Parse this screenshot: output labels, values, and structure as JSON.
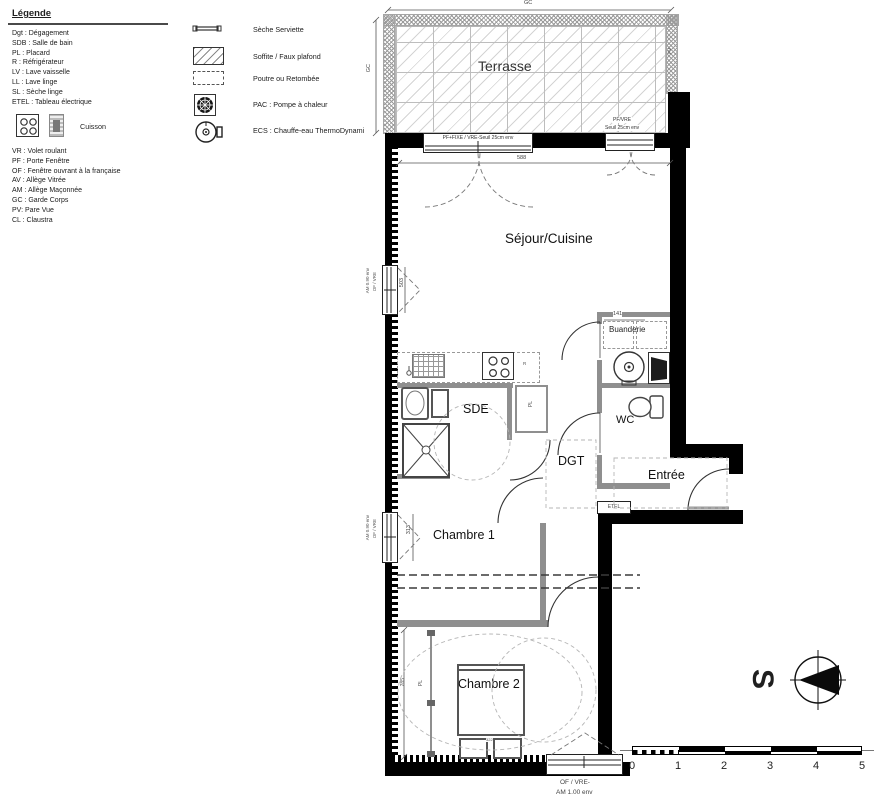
{
  "legend": {
    "title": "Légende",
    "abbr1": [
      "Dgt : Dégagement",
      "SDB : Salle de bain",
      "PL : Placard",
      "R : Réfrigérateur",
      "LV : Lave vaisselle",
      "LL : Lave linge",
      "SL : Sèche linge",
      "ETEL : Tableau électrique"
    ],
    "cuisson": "Cuisson",
    "abbr2": [
      "VR : Volet roulant",
      "PF : Porte Fenêtre",
      "OF : Fenêtre ouvrant à la française",
      "AV : Allège Vitrée",
      "AM : Allège Maçonnée",
      "GC : Garde Corps",
      "PV: Pare Vue",
      "CL : Claustra"
    ],
    "symbols": [
      "Sèche Serviette",
      "Soffite / Faux plafond",
      "Poutre ou Retombée",
      "PAC : Pompe à chaleur",
      "ECS : Chauffe-eau ThermoDynami"
    ]
  },
  "plan": {
    "rooms": {
      "terrasse": "Terrasse",
      "sejour": "Séjour/Cuisine",
      "buanderie": "Buanderie",
      "wc": "WC",
      "sde": "SDE",
      "dgt": "DGT",
      "entree": "Entrée",
      "chambre1": "Chambre 1",
      "chambre2": "Chambre 2"
    },
    "windows": {
      "top_main": "PF+FIXE / VRE-Seuil 25cm env",
      "top_right_l1": "PF/VRE",
      "top_right_l2": "Seuil 25cm env",
      "left_of_vre": "OF / VRE",
      "left_sill": "AM 0.90 env",
      "bottom_l1": "OF / VRE-",
      "bottom_l2": "AM 1.00 env",
      "terrasse_side": "PV"
    },
    "dims": {
      "top_gc": "GC",
      "left_gc": "GC",
      "sejour_width": "588",
      "sejour_window": "503",
      "chambre1_window": "313",
      "buanderie_width": "141",
      "chambre2_height": "285",
      "wardrobe_pl": "PL",
      "bed_width": "322"
    },
    "tags": {
      "etel": "ETEL",
      "pl_closet": "PL",
      "fridge": "R"
    },
    "compass": "S",
    "scale_ticks": [
      "0",
      "1",
      "2",
      "3",
      "4",
      "5"
    ]
  },
  "colors": {
    "wall": "#000000",
    "partition": "#8f8f8f",
    "dashes": "#aaaaaa",
    "text": "#1a1a1a"
  }
}
